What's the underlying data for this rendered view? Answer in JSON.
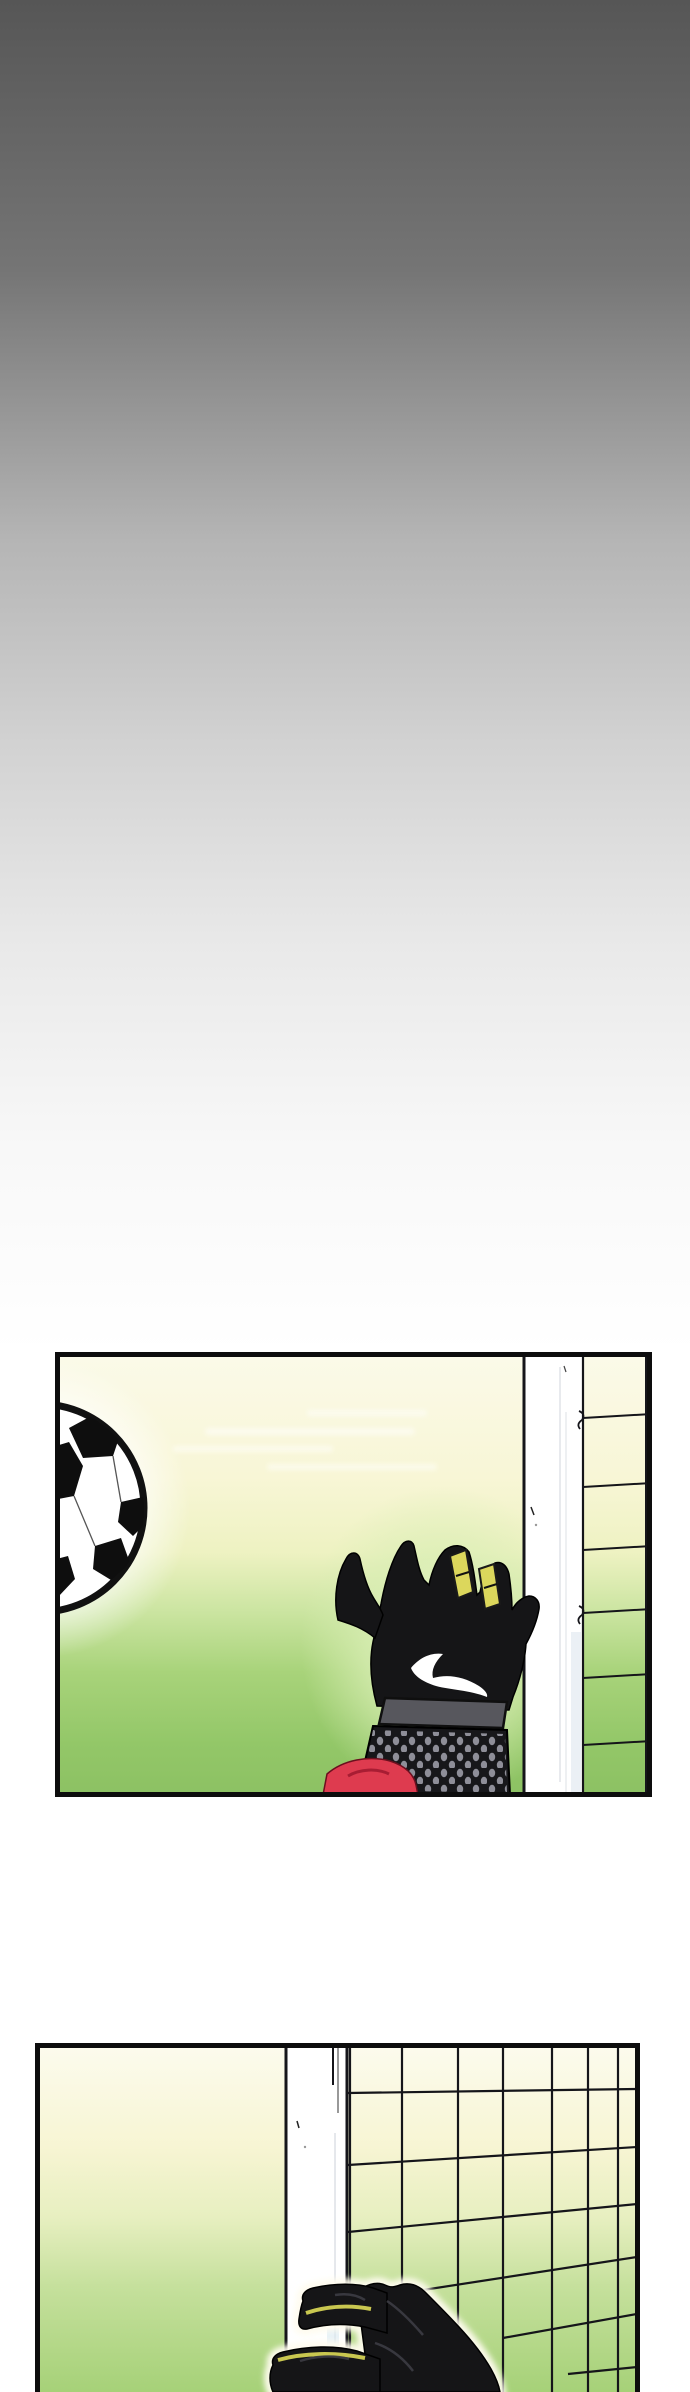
{
  "page": {
    "title": "Webtoon comic page",
    "description": "Vertical comic strip page: dark-gray-to-white gradient space above two comic panels showing a goalkeeper's save at a football goal",
    "width_px": 690,
    "height_px": 2392,
    "panel_count": 2
  },
  "colors": {
    "header_gradient_top": "#565656",
    "header_gradient_bottom": "#ffffff",
    "panel_border": "#0d0d0d",
    "sky_cream": "#fbf9e8",
    "field_green": "#8cc163",
    "glove_black": "#151517",
    "glove_fingertip_yellow": "#dcd75c",
    "swoosh_white": "#ffffff",
    "wrist_band_gray": "#57575d",
    "cuff_dot_gray": "#8e8e98",
    "sleeve_red": "#de3b4f",
    "goal_post_white": "#ffffff",
    "net_line_black": "#15151a",
    "ball_glow_white": "#ffffff",
    "hand_glow_green": "#d9eeb4"
  },
  "panels": [
    {
      "id": "panel-1",
      "description": "A soccer ball flies toward the top-left corner of the goal as a goalkeeper's black glove with yellow fingertips, white swoosh, dotted cuff and red sleeve stretches up; white goal post and net fill the right side over a cream-to-green gradient background",
      "elements": "soccer-ball, goalkeeper-glove, swoosh-mark, wrist-band, glove-cuff, red-sleeve, goal-post, goal-net"
    },
    {
      "id": "panel-2",
      "description": "Close-up of the goalkeeper's black gloved fingers with yellow-green edge highlights gripping in front of the white goal post and the fanned side netting, cream-to-green gradient background",
      "elements": "goalkeeper-glove, goal-post, goal-net"
    }
  ]
}
